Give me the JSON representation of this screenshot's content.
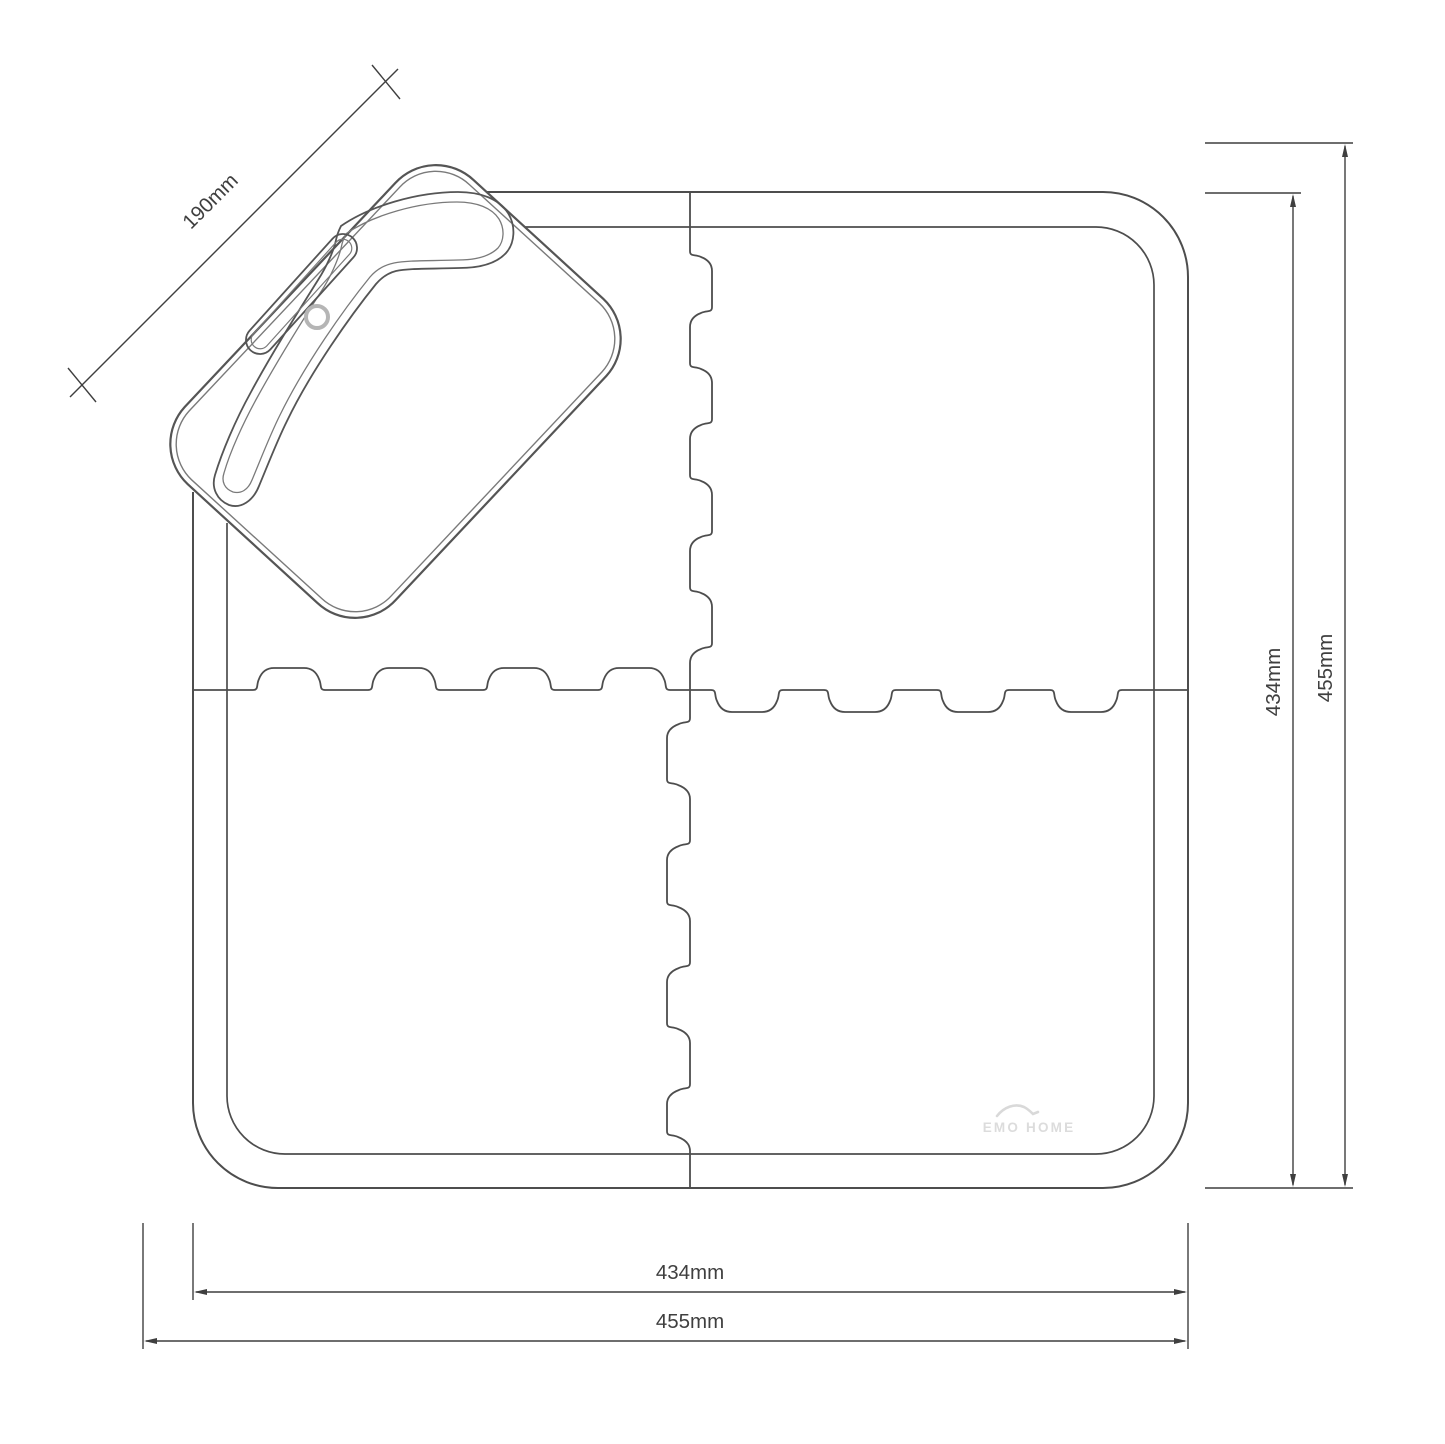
{
  "drawing": {
    "title": "interlocking-mat-technical-drawing",
    "dims": {
      "pad_width": "190mm",
      "right_inner": "434mm",
      "right_outer": "455mm",
      "bottom_inner": "434mm",
      "bottom_outer": "455mm"
    },
    "logo": {
      "text": "EMO HOME"
    },
    "colors": {
      "outline": "#4d4d4d",
      "pad_outline": "#555555",
      "pad_inner_line": "#7a7a7a",
      "dimension": "#3f3f3f",
      "hole_ring": "#b5b5b5",
      "logo_gray": "#d9d9d9",
      "background": "#ffffff"
    }
  }
}
